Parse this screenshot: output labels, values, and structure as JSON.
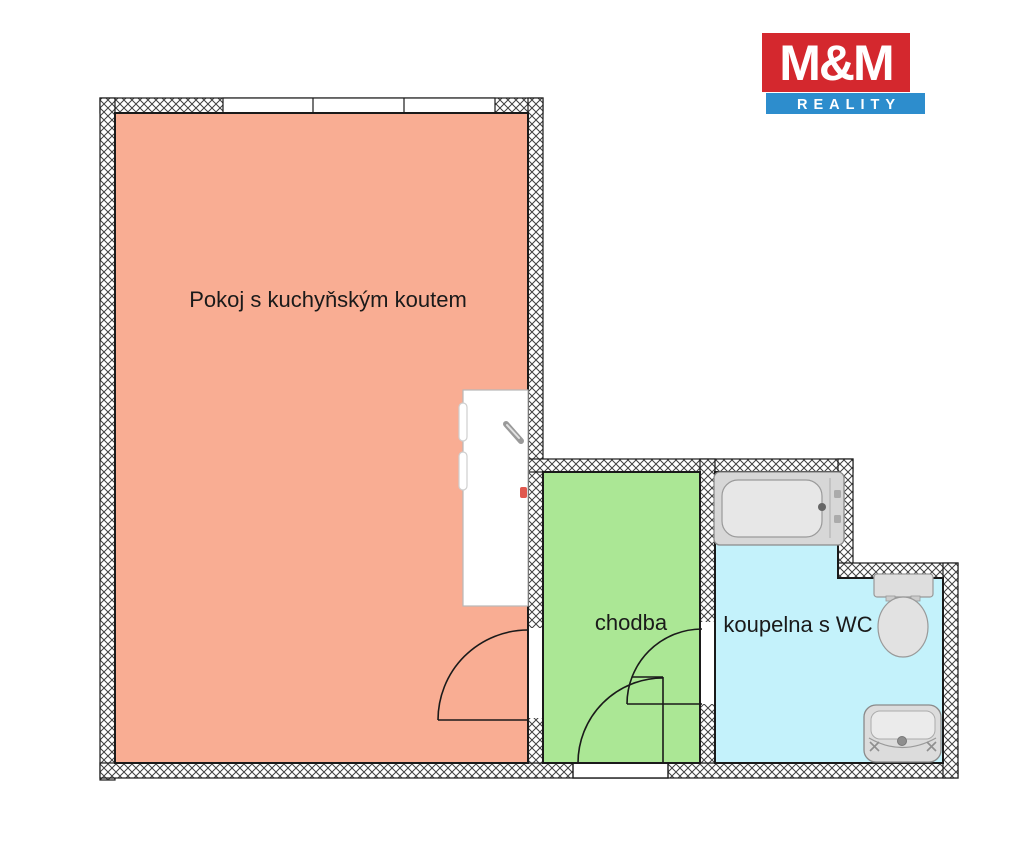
{
  "page": {
    "background": "#ffffff"
  },
  "logo": {
    "top_text": "M&M",
    "bottom_text": "REALITY",
    "red": "#d4282e",
    "blue": "#2d8dcd",
    "text_color": "#ffffff"
  },
  "rooms": {
    "main": {
      "label": "Pokoj s kuchyňským koutem",
      "color": "#f9ad93"
    },
    "hallway": {
      "label": "chodba",
      "color": "#abe795"
    },
    "bathroom": {
      "label": "koupelna s WC",
      "color": "#c4f2fb"
    }
  },
  "colors": {
    "wall_line": "#1a1a1a",
    "hatch_line": "#404040",
    "fixture_fill": "#dcdcdc",
    "fixture_line": "#8a8a8a"
  }
}
